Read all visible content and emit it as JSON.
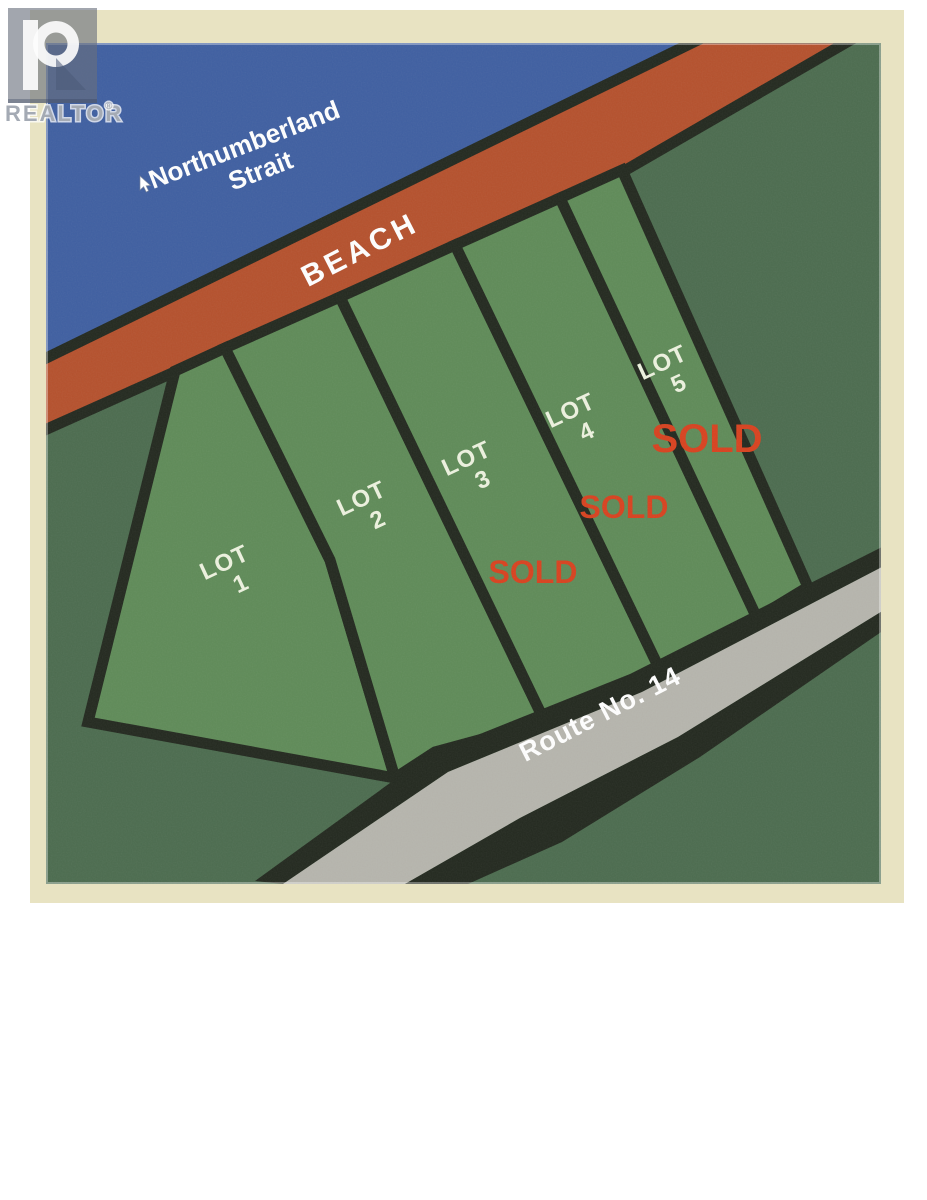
{
  "watermark": {
    "brand": "REALTOR",
    "registered_mark": "®"
  },
  "map": {
    "water_label": {
      "line1": "Northumberland",
      "line2": "Strait"
    },
    "beach_label": "BEACH",
    "road_label": "Route No. 14",
    "lots": [
      {
        "label": "LOT",
        "number": "1",
        "status": ""
      },
      {
        "label": "LOT",
        "number": "2",
        "status": ""
      },
      {
        "label": "LOT",
        "number": "3",
        "status": "SOLD"
      },
      {
        "label": "LOT",
        "number": "4",
        "status": "SOLD"
      },
      {
        "label": "LOT",
        "number": "5",
        "status": "SOLD"
      }
    ],
    "colors": {
      "water": "#3f5fa1",
      "beach": "#b5512d",
      "lot_green": "#5f8b58",
      "background_land": "#4c6c4f",
      "road_gray": "#b6b5ad",
      "boundary_dark": "#23291f",
      "frame_cream": "#e8e3c2",
      "sold_red": "#d8421f",
      "sold_red_dark": "#c53317",
      "lot_text": "#edf2df"
    }
  }
}
